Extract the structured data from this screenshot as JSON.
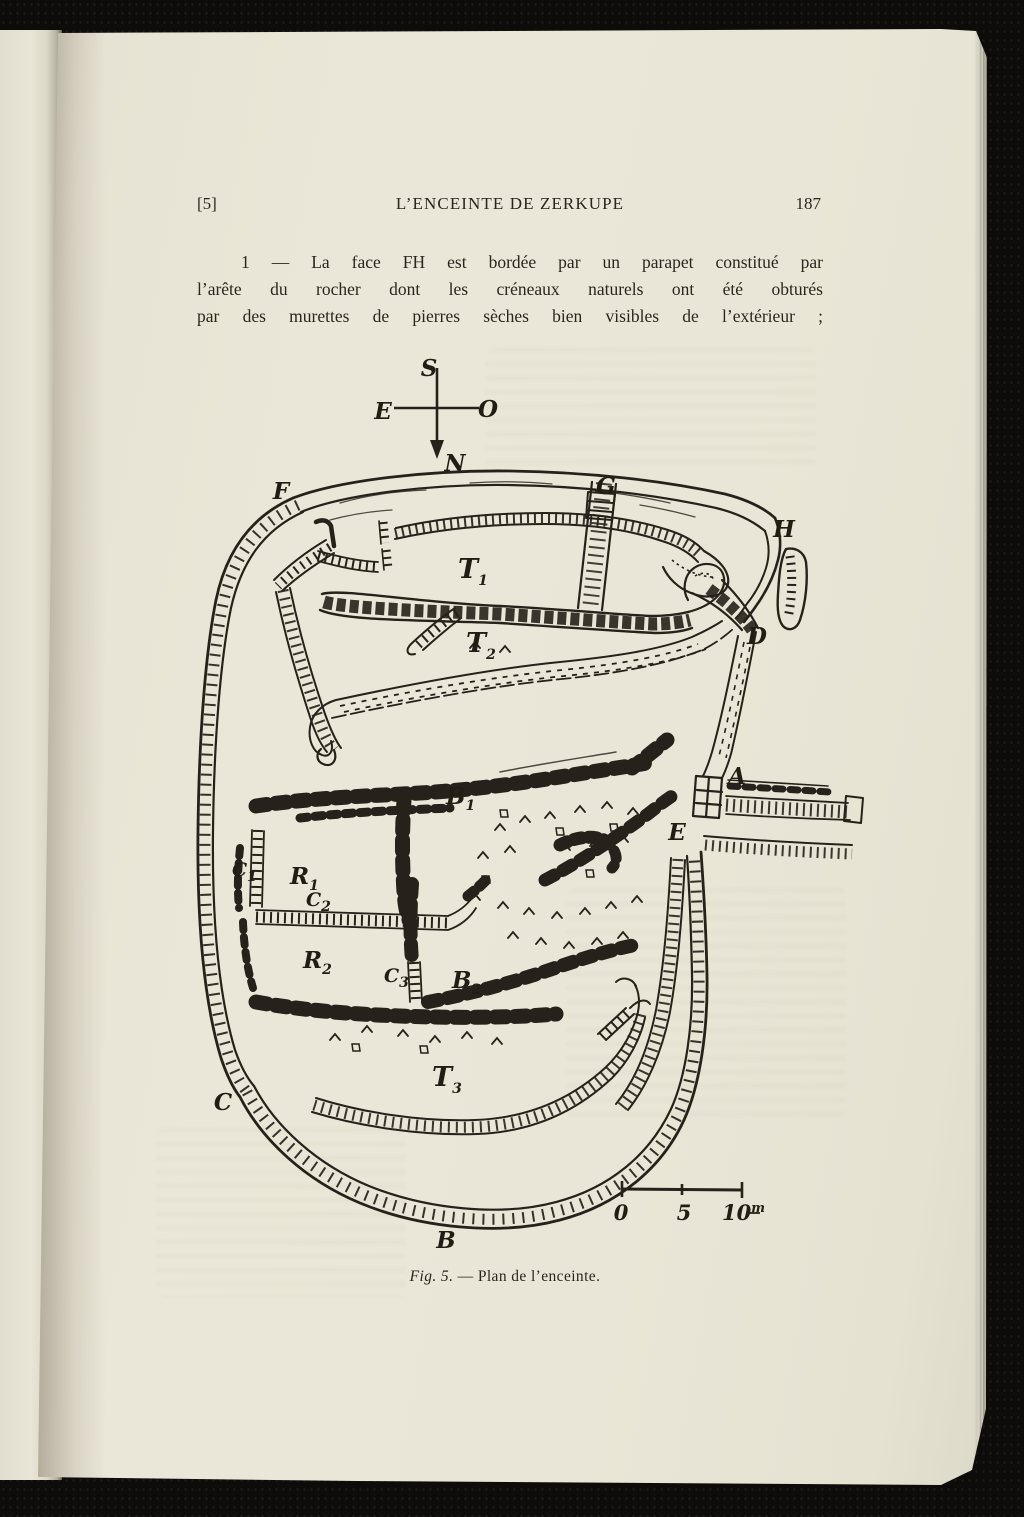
{
  "colors": {
    "ink": "#26211a",
    "paper": "#e9e5d6",
    "backdrop": "#0d0c0a"
  },
  "page": {
    "header": {
      "left": "[5]",
      "center": "L’ENCEINTE DE ZERKUPE",
      "right": "187"
    },
    "paragraph": {
      "lines": [
        "1 — La face FH est bordée par un parapet constitué par",
        "l’arête du rocher dont les créneaux naturels ont été obturés",
        "par des murettes de pierres sèches bien visibles de l’extérieur ;"
      ]
    },
    "caption": {
      "fig": "Fig. 5.",
      "sep": "—",
      "text": "Plan de l’enceinte."
    }
  },
  "figure": {
    "compass": {
      "top": "S",
      "left": "E",
      "right": "O",
      "bottom": "N"
    },
    "labels": {
      "f": "F",
      "g": "G",
      "h": "H",
      "d": "D",
      "a": "A",
      "e": "E",
      "c": "C",
      "b": "B",
      "t1": {
        "base": "T",
        "sub": "1"
      },
      "t2": {
        "base": "T",
        "sub": "2"
      },
      "t3": {
        "base": "T",
        "sub": "3"
      },
      "b1": {
        "base": "B",
        "sub": "1"
      },
      "b2": {
        "base": "B",
        "sub": "2"
      },
      "r1": {
        "base": "R",
        "sub": "1"
      },
      "r2": {
        "base": "R",
        "sub": "2"
      },
      "c1": {
        "base": "C",
        "sub": "1"
      },
      "c2": {
        "base": "C",
        "sub": "2"
      },
      "c3": {
        "base": "C",
        "sub": "3"
      }
    },
    "scale_bar": {
      "tick0": "0",
      "tick5": "5",
      "tick10": "10",
      "unit": "m"
    }
  }
}
